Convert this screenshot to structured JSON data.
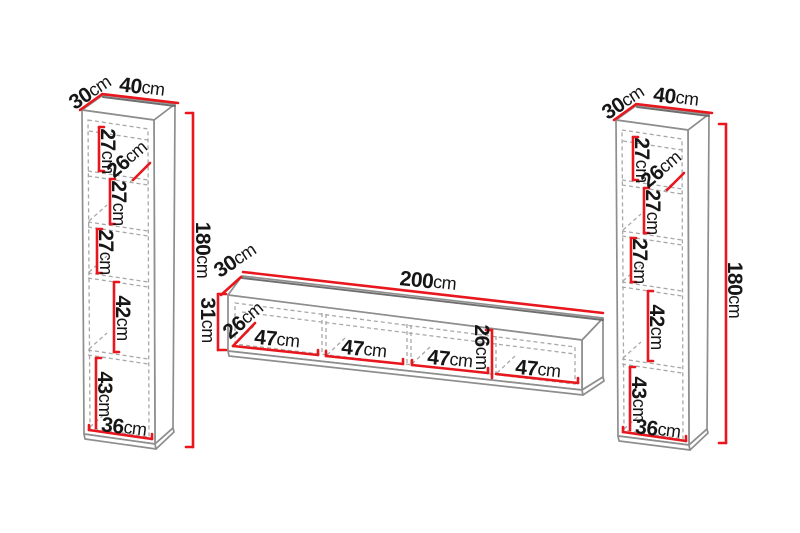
{
  "palette": {
    "dimension_red": "#e8161d",
    "outline_gray": "#8e8e8e",
    "edge_dark": "#6e6e6e",
    "dashed_gray": "#a8a8a8",
    "text_black": "#161616",
    "background": "#ffffff"
  },
  "left_cabinet": {
    "depth": {
      "v": "30",
      "u": "cm"
    },
    "width": {
      "v": "40",
      "u": "cm"
    },
    "height": {
      "v": "180",
      "u": "cm"
    },
    "shelf_1": {
      "v": "27",
      "u": "cm"
    },
    "inner_depth": {
      "v": "26",
      "u": "cm"
    },
    "shelf_2": {
      "v": "27",
      "u": "cm"
    },
    "shelf_3": {
      "v": "27",
      "u": "cm"
    },
    "shelf_4": {
      "v": "42",
      "u": "cm"
    },
    "shelf_5": {
      "v": "43",
      "u": "cm"
    },
    "inner_width": {
      "v": "36",
      "u": "cm"
    }
  },
  "tv_stand": {
    "depth": {
      "v": "30",
      "u": "cm"
    },
    "width": {
      "v": "200",
      "u": "cm"
    },
    "height": {
      "v": "31",
      "u": "cm"
    },
    "inner_depth": {
      "v": "26",
      "u": "cm"
    },
    "inner_height": {
      "v": "26",
      "u": "cm"
    },
    "compartment_1": {
      "v": "47",
      "u": "cm"
    },
    "compartment_2": {
      "v": "47",
      "u": "cm"
    },
    "compartment_3": {
      "v": "47",
      "u": "cm"
    },
    "compartment_4": {
      "v": "47",
      "u": "cm"
    }
  },
  "right_cabinet": {
    "depth": {
      "v": "30",
      "u": "cm"
    },
    "width": {
      "v": "40",
      "u": "cm"
    },
    "height": {
      "v": "180",
      "u": "cm"
    },
    "shelf_1": {
      "v": "27",
      "u": "cm"
    },
    "inner_depth": {
      "v": "26",
      "u": "cm"
    },
    "shelf_2": {
      "v": "27",
      "u": "cm"
    },
    "shelf_3": {
      "v": "27",
      "u": "cm"
    },
    "shelf_4": {
      "v": "42",
      "u": "cm"
    },
    "shelf_5": {
      "v": "43",
      "u": "cm"
    },
    "inner_width": {
      "v": "36",
      "u": "cm"
    }
  }
}
